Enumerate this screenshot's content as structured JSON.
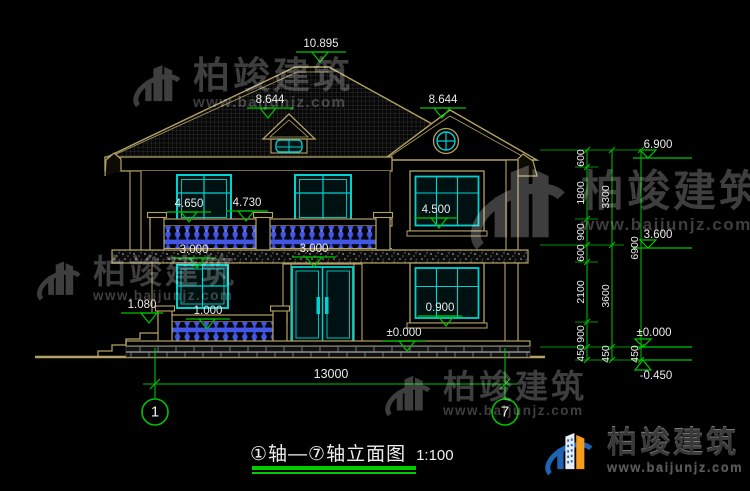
{
  "title": {
    "text": "①轴—⑦轴立面图",
    "scale": "1:100"
  },
  "axes": {
    "start": "1",
    "end": "7"
  },
  "width_dim": "13000",
  "marks": {
    "peak": "10.895",
    "ridge_left": "8.644",
    "ridge_right": "8.644",
    "win2f_left_sill": "4.650",
    "balcony_rail": "4.730",
    "win2f_right_sill": "4.500",
    "floor2_left": "3.000",
    "floor2_mid": "3.000",
    "porch_rail": "1.080",
    "porch_sill": "1.000",
    "win1f_right_sill": "0.900",
    "ground_floor": "±0.000",
    "right_eave": "6.900",
    "right_floor2": "3.600",
    "right_zero": "±0.000",
    "right_grade": "-0.450"
  },
  "chains": {
    "inner": [
      "600",
      "1800",
      "900",
      "600",
      "2100",
      "900",
      "450"
    ],
    "mid": [
      "3300",
      "3600",
      "450"
    ],
    "outer": [
      "6900",
      "450"
    ]
  },
  "watermark": {
    "brand": "柏竣建筑",
    "url": "www.baijunjz.com"
  },
  "colors": {
    "background": "#000000",
    "line_tan": "#b5a364",
    "cad_green": "#00c300",
    "glass_cyan": "#00d2d2",
    "baluster_blue": "#4156e2",
    "label_white": "#eaeaea",
    "watermark_gray": "#3e3e3e",
    "logo_blue": "#1f63b5",
    "logo_orange": "#f49d1d"
  }
}
